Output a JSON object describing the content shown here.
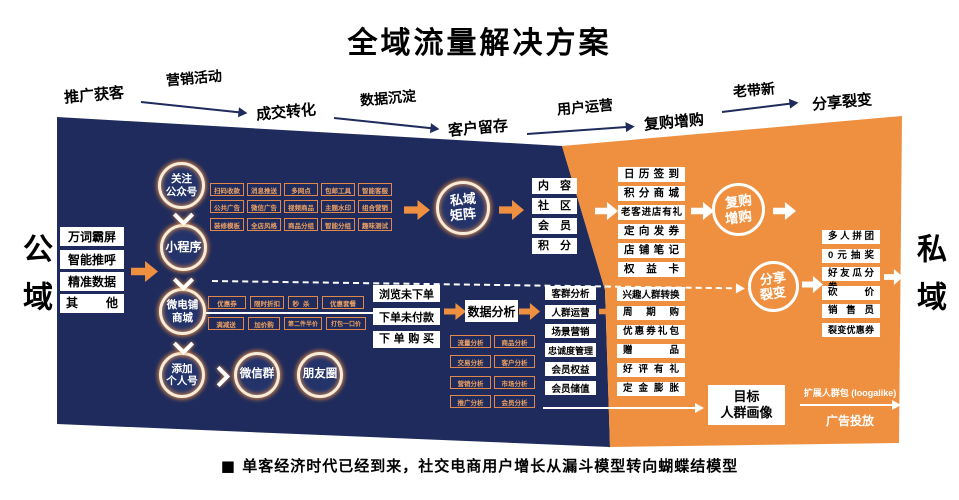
{
  "title": "全域流量解决方案",
  "domains": {
    "left": "公域",
    "right": "私域"
  },
  "top_flow": {
    "stage1": "推广获客",
    "link1": "营销活动",
    "stage2": "成交转化",
    "link2": "数据沉淀",
    "stage3": "客户留存",
    "link3": "用户运营",
    "stage4": "复购增购",
    "link4": "老带新",
    "stage5": "分享裂变"
  },
  "acquisition": [
    "万词霸屏",
    "智能推呼",
    "精准数据",
    "其他"
  ],
  "funnel": {
    "node1": [
      "关注",
      "公众号"
    ],
    "node2": "小程序",
    "node3": [
      "微电铺",
      "商城"
    ],
    "node4": [
      "添加",
      "个人号"
    ],
    "wechat_group": "微信群",
    "moments": "朋友圈"
  },
  "mp_features": [
    "扫码收款",
    "消息推送",
    "多网点",
    "包邮工具",
    "智能客服",
    "公共广告",
    "微信广告",
    "视频商品",
    "主题水印",
    "组合营销",
    "装修模板",
    "全店风格",
    "商品分组",
    "智能分组",
    "趣味测试"
  ],
  "shop_features": [
    "优惠券",
    "限时折扣",
    "秒杀",
    "优惠套餐",
    "满减送",
    "加价购",
    "第二件半价",
    "打包一口价"
  ],
  "matrix": {
    "label": [
      "私域",
      "矩阵"
    ],
    "pillars": [
      "内容",
      "社区",
      "会员",
      "积分"
    ]
  },
  "orders": [
    "浏览未下单",
    "下单未付款",
    "下单购买"
  ],
  "analysis": {
    "label": "数据分析",
    "grid": [
      "流量分析",
      "商品分析",
      "交易分析",
      "客户分析",
      "营销分析",
      "市场分析",
      "推广分析",
      "会员分析"
    ]
  },
  "operation": [
    "客群分析",
    "人群运营",
    "场景营销",
    "忠诚度管理",
    "会员权益",
    "会员储值"
  ],
  "repurchase": {
    "label": [
      "复购",
      "增购"
    ],
    "tactics": [
      "日历签到",
      "积分商城",
      "老客进店有礼",
      "定向发券",
      "店铺笔记",
      "权益卡"
    ]
  },
  "fission": {
    "label": [
      "分享",
      "裂变"
    ],
    "tactics": [
      "兴趣人群转换",
      "周期购",
      "优惠券礼包",
      "赠品",
      "好评有礼",
      "定金膨胀"
    ],
    "tools": [
      "多人拼团",
      "0元抽奖",
      "好友瓜分券",
      "砍价",
      "销售员",
      "裂变优惠券"
    ]
  },
  "audience": {
    "portrait": [
      "目标",
      "人群画像"
    ],
    "lookalike": "扩展人群包 (loogalike)",
    "ads": "广告投放"
  },
  "footnote": "■  单客经济时代已经到来，社交电商用户增长从漏斗模型转向蝴蝶结模型",
  "colors": {
    "navy": "#1e2b5c",
    "orange": "#ef9040"
  }
}
